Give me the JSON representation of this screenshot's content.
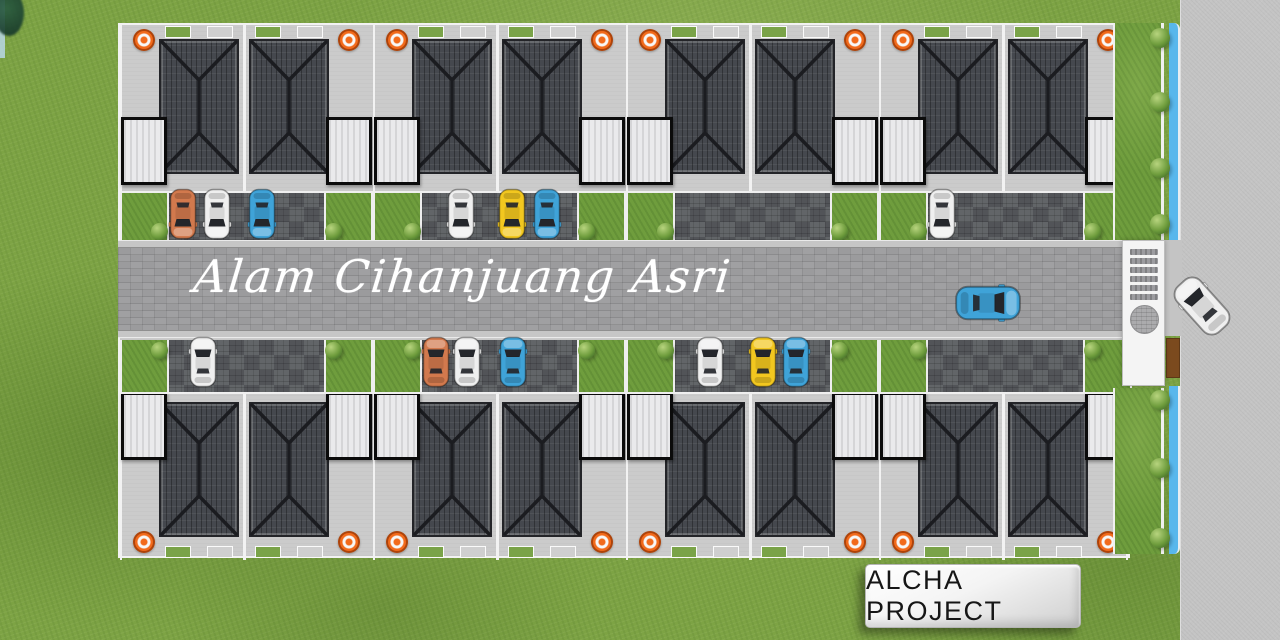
{
  "labels": {
    "street_name": "Alam Cihanjuang Asri",
    "project_badge": "ALCHA PROJECT"
  },
  "site": {
    "rows": 2,
    "blocks_per_row": 4,
    "houses_per_block": 2,
    "carports_per_block": 2,
    "water_tanks_per_block": 2,
    "canal_bush_ys": [
      28,
      92,
      158,
      214,
      390,
      458,
      528
    ]
  },
  "palette": {
    "grass": "#7DA344",
    "site_base": "#CBCBCB",
    "roof": "#45484E",
    "roof_ridge": "#1B1C20",
    "carport": "#EAEAEC",
    "tank_orange": "#F26A1B",
    "driveway": "#56595D",
    "yard_green": "#6F9D3D",
    "road": "#9B9B9D",
    "canal_blue": "#58B7EC",
    "outer_road": "#C4C4C4",
    "gate_white": "#F4F4F4",
    "barrier_brown": "#7B4A1E",
    "car_white": "#EFEFEF",
    "car_orange": "#D2794D",
    "car_blue": "#3FA3D8",
    "car_yellow": "#F2C71F",
    "car_glass": "#24262B"
  },
  "cars": [
    {
      "area": "top-strip",
      "x": 183,
      "y": 214,
      "rot": 180,
      "scale": 1,
      "color": "orange"
    },
    {
      "area": "top-strip",
      "x": 217,
      "y": 214,
      "rot": 180,
      "scale": 1,
      "color": "white"
    },
    {
      "area": "top-strip",
      "x": 262,
      "y": 214,
      "rot": 180,
      "scale": 1,
      "color": "blue"
    },
    {
      "area": "top-strip",
      "x": 461,
      "y": 214,
      "rot": 180,
      "scale": 1,
      "color": "white"
    },
    {
      "area": "top-strip",
      "x": 512,
      "y": 214,
      "rot": 180,
      "scale": 1,
      "color": "yellow"
    },
    {
      "area": "top-strip",
      "x": 547,
      "y": 214,
      "rot": 180,
      "scale": 1,
      "color": "blue"
    },
    {
      "area": "top-strip",
      "x": 942,
      "y": 214,
      "rot": 180,
      "scale": 1,
      "color": "white"
    },
    {
      "area": "bottom-strip",
      "x": 203,
      "y": 362,
      "rot": 0,
      "scale": 1,
      "color": "white"
    },
    {
      "area": "bottom-strip",
      "x": 436,
      "y": 362,
      "rot": 0,
      "scale": 1,
      "color": "orange"
    },
    {
      "area": "bottom-strip",
      "x": 467,
      "y": 362,
      "rot": 0,
      "scale": 1,
      "color": "white"
    },
    {
      "area": "bottom-strip",
      "x": 513,
      "y": 362,
      "rot": 0,
      "scale": 1,
      "color": "blue"
    },
    {
      "area": "bottom-strip",
      "x": 710,
      "y": 362,
      "rot": 0,
      "scale": 1,
      "color": "white"
    },
    {
      "area": "bottom-strip",
      "x": 763,
      "y": 362,
      "rot": 0,
      "scale": 1,
      "color": "yellow"
    },
    {
      "area": "bottom-strip",
      "x": 796,
      "y": 362,
      "rot": 0,
      "scale": 1,
      "color": "blue"
    },
    {
      "area": "road",
      "x": 988,
      "y": 303,
      "rot": 90,
      "scale": 1.3,
      "color": "blue"
    },
    {
      "area": "entrance",
      "x": 1202,
      "y": 306,
      "rot": -42,
      "scale": 1.25,
      "color": "white"
    }
  ]
}
